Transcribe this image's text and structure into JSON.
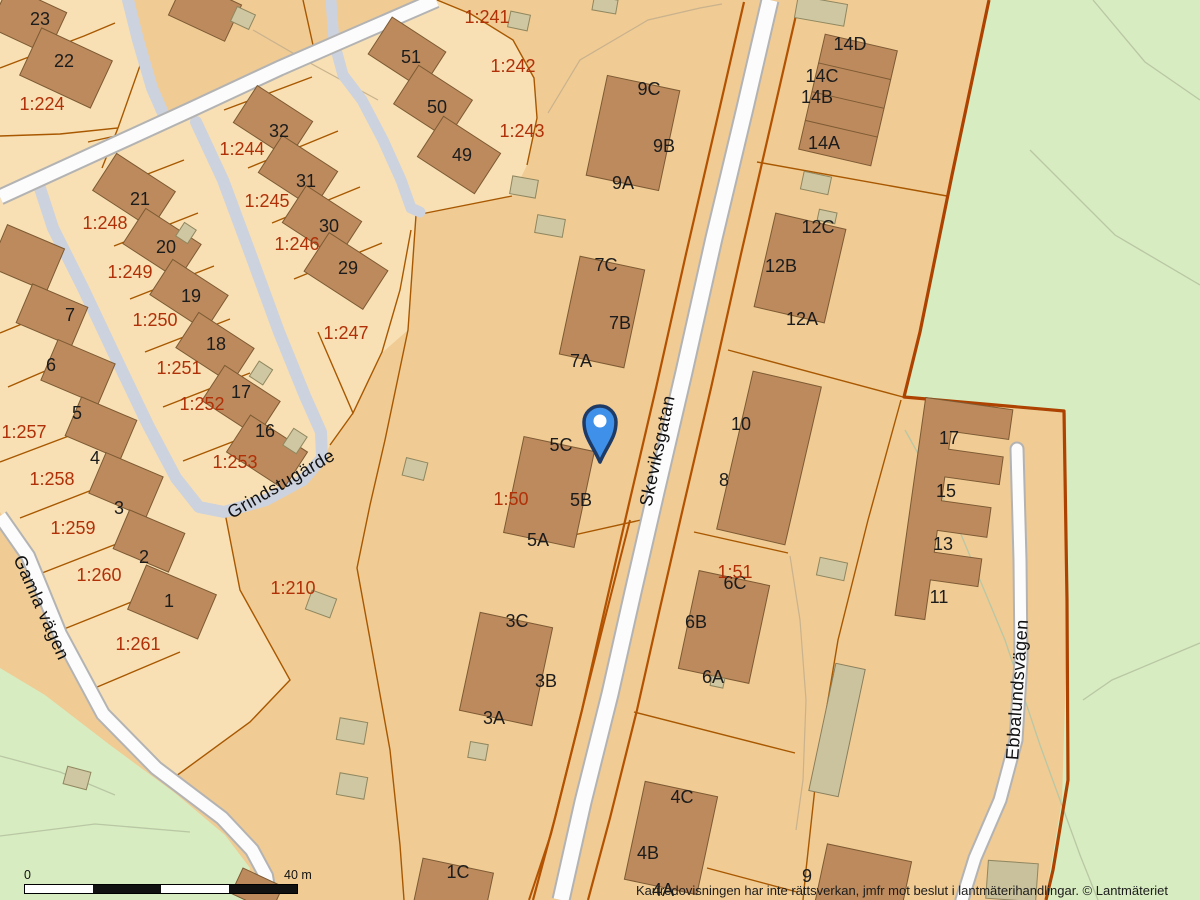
{
  "map": {
    "attribution": "Kartredovisningen har inte rättsverkan, jmfr mot beslut i lantmäterihandlingar. © Lantmäteriet",
    "scale_bar": {
      "start_label": "0",
      "end_label": "40 m"
    },
    "marker": {
      "name": "location-pin",
      "color": "#3f90e8",
      "border_color": "#1d3b66"
    },
    "colors": {
      "base_parcel": "#f0cb94",
      "light_parcel": "#f8e0b4",
      "green_area": "#d7ecc0",
      "building_fill": "#bc8a5c",
      "building_stroke": "#7d5a33",
      "shed_fill": "#cfc6a2",
      "road_fill": "#fcfcfc",
      "road_casing": "#b3b3b3",
      "path_fill": "#ccd2de",
      "parcel_line": "#a85800",
      "boundary_thick": "#ae4200",
      "building_label": "#1c1c1c",
      "parcel_label": "#b03008"
    },
    "labels": {
      "buildings": [
        {
          "t": "23",
          "x": 40,
          "y": 25
        },
        {
          "t": "22",
          "x": 64,
          "y": 67
        },
        {
          "t": "51",
          "x": 411,
          "y": 63
        },
        {
          "t": "50",
          "x": 437,
          "y": 113
        },
        {
          "t": "49",
          "x": 462,
          "y": 161
        },
        {
          "t": "32",
          "x": 279,
          "y": 137
        },
        {
          "t": "31",
          "x": 306,
          "y": 187
        },
        {
          "t": "30",
          "x": 329,
          "y": 232
        },
        {
          "t": "29",
          "x": 348,
          "y": 274
        },
        {
          "t": "21",
          "x": 140,
          "y": 205
        },
        {
          "t": "20",
          "x": 166,
          "y": 253
        },
        {
          "t": "19",
          "x": 191,
          "y": 302
        },
        {
          "t": "18",
          "x": 216,
          "y": 350
        },
        {
          "t": "17",
          "x": 241,
          "y": 398
        },
        {
          "t": "16",
          "x": 265,
          "y": 437
        },
        {
          "t": "7",
          "x": 70,
          "y": 321
        },
        {
          "t": "6",
          "x": 51,
          "y": 371
        },
        {
          "t": "5",
          "x": 77,
          "y": 419
        },
        {
          "t": "4",
          "x": 95,
          "y": 464
        },
        {
          "t": "3",
          "x": 119,
          "y": 514
        },
        {
          "t": "2",
          "x": 144,
          "y": 563
        },
        {
          "t": "1",
          "x": 169,
          "y": 607
        },
        {
          "t": "9C",
          "x": 649,
          "y": 95
        },
        {
          "t": "9B",
          "x": 664,
          "y": 152
        },
        {
          "t": "9A",
          "x": 623,
          "y": 189
        },
        {
          "t": "7C",
          "x": 606,
          "y": 271
        },
        {
          "t": "7B",
          "x": 620,
          "y": 329
        },
        {
          "t": "7A",
          "x": 581,
          "y": 367
        },
        {
          "t": "5C",
          "x": 561,
          "y": 451
        },
        {
          "t": "5B",
          "x": 581,
          "y": 506
        },
        {
          "t": "5A",
          "x": 538,
          "y": 546
        },
        {
          "t": "3C",
          "x": 517,
          "y": 627
        },
        {
          "t": "3B",
          "x": 546,
          "y": 687
        },
        {
          "t": "3A",
          "x": 494,
          "y": 724
        },
        {
          "t": "1C",
          "x": 458,
          "y": 878
        },
        {
          "t": "14D",
          "x": 850,
          "y": 50
        },
        {
          "t": "14C",
          "x": 822,
          "y": 82
        },
        {
          "t": "14B",
          "x": 817,
          "y": 103
        },
        {
          "t": "14A",
          "x": 824,
          "y": 149
        },
        {
          "t": "12C",
          "x": 818,
          "y": 233
        },
        {
          "t": "12B",
          "x": 781,
          "y": 272
        },
        {
          "t": "12A",
          "x": 802,
          "y": 325
        },
        {
          "t": "10",
          "x": 741,
          "y": 430
        },
        {
          "t": "8",
          "x": 724,
          "y": 486
        },
        {
          "t": "6C",
          "x": 735,
          "y": 589
        },
        {
          "t": "6B",
          "x": 696,
          "y": 628
        },
        {
          "t": "6A",
          "x": 713,
          "y": 683
        },
        {
          "t": "4C",
          "x": 682,
          "y": 803
        },
        {
          "t": "4B",
          "x": 648,
          "y": 859
        },
        {
          "t": "4A",
          "x": 663,
          "y": 896
        },
        {
          "t": "9",
          "x": 807,
          "y": 882
        },
        {
          "t": "17",
          "x": 949,
          "y": 444
        },
        {
          "t": "15",
          "x": 946,
          "y": 497
        },
        {
          "t": "13",
          "x": 943,
          "y": 550
        },
        {
          "t": "11",
          "x": 939,
          "y": 603
        }
      ],
      "parcels": [
        {
          "t": "1:224",
          "x": 42,
          "y": 110
        },
        {
          "t": "1:241",
          "x": 487,
          "y": 23
        },
        {
          "t": "1:242",
          "x": 513,
          "y": 72
        },
        {
          "t": "1:243",
          "x": 522,
          "y": 137
        },
        {
          "t": "1:244",
          "x": 242,
          "y": 155
        },
        {
          "t": "1:245",
          "x": 267,
          "y": 207
        },
        {
          "t": "1:246",
          "x": 297,
          "y": 250
        },
        {
          "t": "1:247",
          "x": 346,
          "y": 339
        },
        {
          "t": "1:248",
          "x": 105,
          "y": 229
        },
        {
          "t": "1:249",
          "x": 130,
          "y": 278
        },
        {
          "t": "1:250",
          "x": 155,
          "y": 326
        },
        {
          "t": "1:251",
          "x": 179,
          "y": 374
        },
        {
          "t": "1:252",
          "x": 202,
          "y": 410
        },
        {
          "t": "1:253",
          "x": 235,
          "y": 468
        },
        {
          "t": "1:257",
          "x": 24,
          "y": 438
        },
        {
          "t": "1:258",
          "x": 52,
          "y": 485
        },
        {
          "t": "1:259",
          "x": 73,
          "y": 534
        },
        {
          "t": "1:260",
          "x": 99,
          "y": 581
        },
        {
          "t": "1:261",
          "x": 138,
          "y": 650
        },
        {
          "t": "1:210",
          "x": 293,
          "y": 594
        },
        {
          "t": "1:50",
          "x": 511,
          "y": 505
        },
        {
          "t": "1:51",
          "x": 735,
          "y": 578
        }
      ],
      "streets": [
        {
          "t": "Skeviksgatan",
          "x": 663,
          "y": 452,
          "r": -78
        },
        {
          "t": "Grindstugärde",
          "x": 284,
          "y": 489,
          "r": -30
        },
        {
          "t": "Gamla vägen",
          "x": 36,
          "y": 610,
          "r": 66
        },
        {
          "t": "Ebbalundsvägen",
          "x": 1023,
          "y": 690,
          "r": -86
        }
      ]
    }
  }
}
